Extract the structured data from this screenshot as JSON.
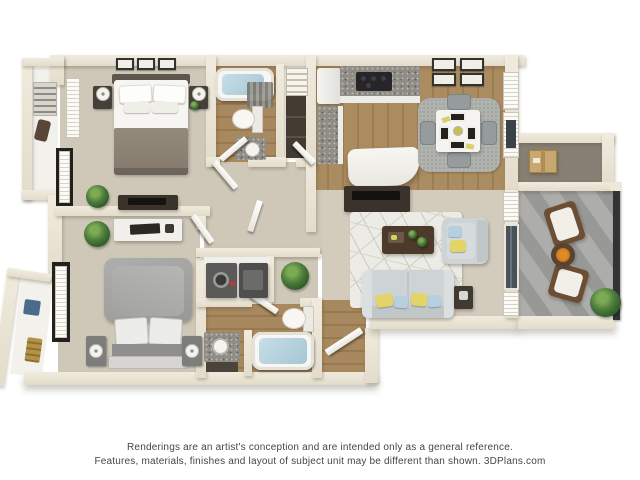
{
  "image": {
    "kind": "3D floor plan rendering of a two-bedroom, two-bathroom apartment",
    "brand": "3DPlans.com"
  },
  "disclaimer": {
    "line1": "Renderings are an artist's conception and are intended only as a general reference.",
    "line2": "Features, materials, finishes and layout of subject unit may be different than shown. 3DPlans.com"
  },
  "rooms": [
    "master bedroom",
    "master closet",
    "bathroom one",
    "linen closet",
    "kitchen",
    "dining area",
    "living room",
    "hallway",
    "bedroom two",
    "entry closet",
    "laundry closet",
    "bathroom two",
    "entry",
    "storage closet",
    "balcony"
  ],
  "furnishings": [
    "queen bed with taupe blanket",
    "nightstands with lamps",
    "three wall frames",
    "dresser with tv",
    "potted plants",
    "desk with laptop",
    "gray draped bed",
    "bedside towers with lamps",
    "bathtubs with water",
    "toilets",
    "vanity sinks",
    "washer and dryer",
    "refrigerator",
    "range with granite counters",
    "kitchen island",
    "four frames over dining",
    "square dining table with four gray chairs",
    "area rugs",
    "sofa with yellow and blue pillows",
    "armchair",
    "dark wood coffee table",
    "tv console",
    "side table",
    "cardboard box in storage",
    "two wooden balcony chairs with white cushions",
    "round balcony table with fruit",
    "balcony railing"
  ],
  "palette": {
    "background": "#ffffff",
    "wall": "#e8e2d3",
    "carpet": "#cfc8b9",
    "wood_floor": "#a8885e",
    "balcony_floor": "#a2a2a0",
    "storage_floor": "#877f73",
    "bath_water": "#b9d6e0",
    "sofa": "#ced4d5",
    "pillow_yellow": "#e3d469",
    "pillow_blue": "#b7cfdf",
    "coffee_table": "#4c3b2b",
    "tv_console": "#3a332b",
    "plant_green": "#4c7c3c",
    "cardboard_box": "#c8a770",
    "bed1_blanket": "#8c8173",
    "bed2_blanket": "#a3a3a1",
    "granite": "#8f8d85",
    "railing": "#333333",
    "disclaimer_text": "#454545"
  }
}
